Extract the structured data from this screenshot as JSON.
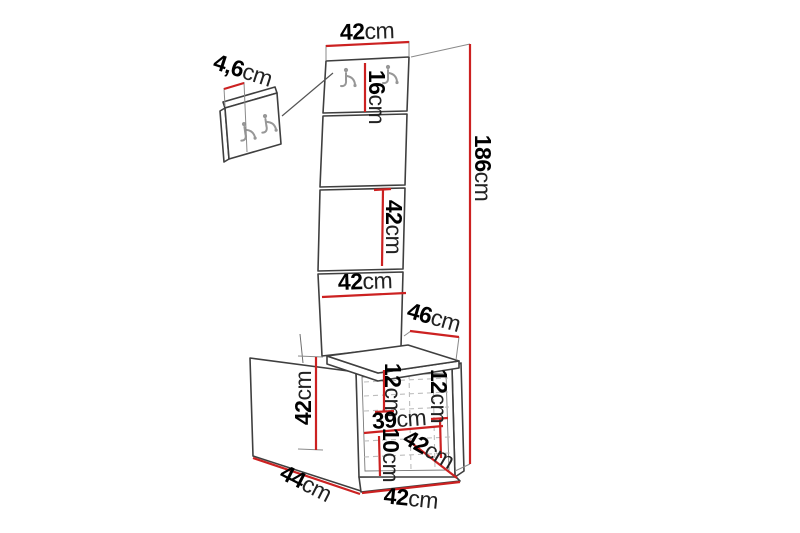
{
  "diagram": {
    "kind": "hallway-furniture-dimension-drawing",
    "background": "#ffffff",
    "line_color": "#3f3f3f",
    "dimension_color": "#cc2121",
    "hook_color": "#979797",
    "unit": "cm"
  },
  "dims": {
    "panel_top_width": {
      "value": "42",
      "unit": "cm"
    },
    "hook_panel_height": {
      "value": "16",
      "unit": "cm"
    },
    "hook_plate_depth": {
      "value": "4,6",
      "unit": "cm"
    },
    "panel_section_height": {
      "value": "42",
      "unit": "cm"
    },
    "total_height": {
      "value": "186",
      "unit": "cm"
    },
    "panel_mid_width": {
      "value": "42",
      "unit": "cm"
    },
    "seat_depth": {
      "value": "46",
      "unit": "cm"
    },
    "bench_height": {
      "value": "42",
      "unit": "cm"
    },
    "drawer_left_height": {
      "value": "12",
      "unit": "cm"
    },
    "drawer_right_height": {
      "value": "12",
      "unit": "cm"
    },
    "inner_width": {
      "value": "39",
      "unit": "cm"
    },
    "plinth_height": {
      "value": "10",
      "unit": "cm"
    },
    "bench_depth_right": {
      "value": "42",
      "unit": "cm"
    },
    "base_depth": {
      "value": "44",
      "unit": "cm"
    },
    "base_width": {
      "value": "42",
      "unit": "cm"
    }
  }
}
